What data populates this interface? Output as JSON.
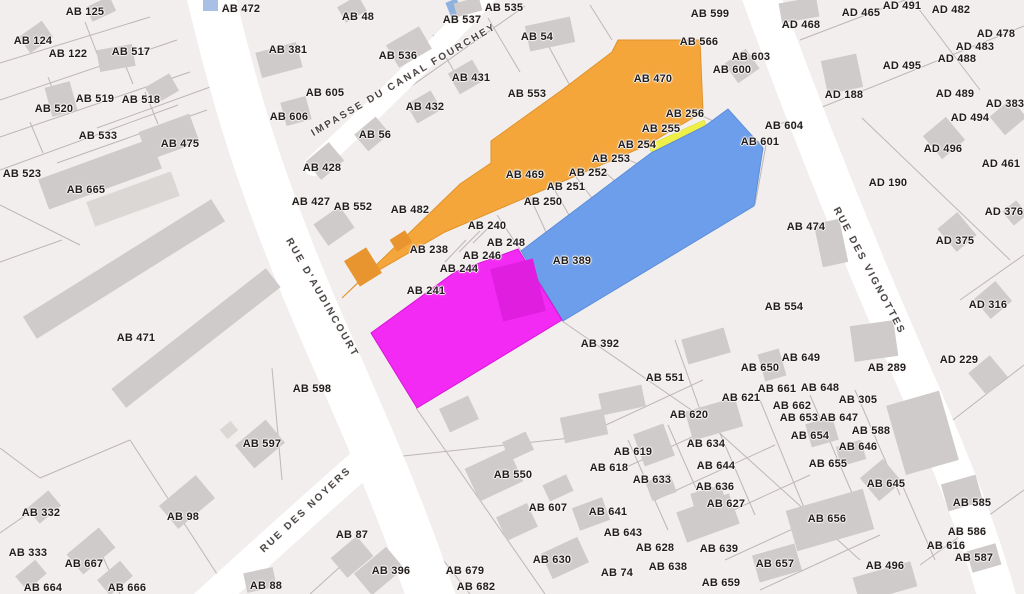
{
  "map": {
    "type": "cadastral-parcel-map",
    "colors": {
      "background": "#f2eeed",
      "road": "#ffffff",
      "building": "#cfcbca",
      "building_light": "#dbd7d5",
      "boundary_line": "#b9b3b2",
      "label_text": "#211d1d",
      "water": "#8fb1e0"
    },
    "highlights": {
      "orange": {
        "color": "#f5a63a",
        "stroke": "#e0932b",
        "parcels": [
          "AB 469",
          "AB 470",
          "AB 255",
          "AB 256"
        ]
      },
      "blue": {
        "color": "#6d9eeb",
        "stroke": "#5d8ed8",
        "parcels": [
          "AB 389"
        ]
      },
      "yellow": {
        "color": "#eff045",
        "stroke": "#d6d63a",
        "parcels": []
      },
      "magenta": {
        "color": "#f32af3",
        "stroke": "#d815d8",
        "parcels": []
      },
      "magenta_building": "#e01ee0",
      "orange_building": "#e8952f"
    },
    "streets": [
      {
        "id": "impasse-du-canal-fourchey",
        "name": "IMPASSE DU CANAL FOURCHEY",
        "x": 404,
        "y": 80,
        "rotation": -30.5
      },
      {
        "id": "rue-d-audincourt",
        "name": "RUE D'AUDINCOURT",
        "x": 322,
        "y": 298,
        "rotation": 60
      },
      {
        "id": "rue-des-noyers",
        "name": "RUE DES NOYERS",
        "x": 306,
        "y": 510,
        "rotation": -43
      },
      {
        "id": "rue-des-vignottes",
        "name": "RUE DES VIGNOTTES",
        "x": 869,
        "y": 271,
        "rotation": 62
      }
    ],
    "parcel_labels": [
      {
        "t": "AB 125",
        "x": 85,
        "y": 12
      },
      {
        "t": "AB 124",
        "x": 33,
        "y": 41
      },
      {
        "t": "AB 122",
        "x": 68,
        "y": 54
      },
      {
        "t": "AB 517",
        "x": 131,
        "y": 52
      },
      {
        "t": "AB 519",
        "x": 95,
        "y": 99
      },
      {
        "t": "AB 518",
        "x": 141,
        "y": 100
      },
      {
        "t": "AB 520",
        "x": 54,
        "y": 109
      },
      {
        "t": "AB 533",
        "x": 98,
        "y": 136
      },
      {
        "t": "AB 475",
        "x": 180,
        "y": 144
      },
      {
        "t": "AB 523",
        "x": 22,
        "y": 174
      },
      {
        "t": "AB 665",
        "x": 86,
        "y": 190
      },
      {
        "t": "AB 472",
        "x": 241,
        "y": 9
      },
      {
        "t": "AB 381",
        "x": 288,
        "y": 50
      },
      {
        "t": "AB 605",
        "x": 325,
        "y": 93
      },
      {
        "t": "AB 606",
        "x": 289,
        "y": 117
      },
      {
        "t": "AB 428",
        "x": 322,
        "y": 168
      },
      {
        "t": "AB 427",
        "x": 311,
        "y": 202
      },
      {
        "t": "AB 552",
        "x": 353,
        "y": 207
      },
      {
        "t": "AB 482",
        "x": 410,
        "y": 210
      },
      {
        "t": "AB 48",
        "x": 358,
        "y": 17
      },
      {
        "t": "AB 537",
        "x": 462,
        "y": 20
      },
      {
        "t": "AB 535",
        "x": 504,
        "y": 8
      },
      {
        "t": "AB 54",
        "x": 537,
        "y": 37
      },
      {
        "t": "AB 536",
        "x": 398,
        "y": 56
      },
      {
        "t": "AB 431",
        "x": 471,
        "y": 78
      },
      {
        "t": "AB 553",
        "x": 527,
        "y": 94
      },
      {
        "t": "AB 432",
        "x": 425,
        "y": 107
      },
      {
        "t": "AB 56",
        "x": 375,
        "y": 135
      },
      {
        "t": "AB 470",
        "x": 653,
        "y": 79
      },
      {
        "t": "AB 256",
        "x": 685,
        "y": 114
      },
      {
        "t": "AB 255",
        "x": 661,
        "y": 129
      },
      {
        "t": "AB 254",
        "x": 637,
        "y": 145
      },
      {
        "t": "AB 253",
        "x": 611,
        "y": 159
      },
      {
        "t": "AB 252",
        "x": 588,
        "y": 173
      },
      {
        "t": "AB 251",
        "x": 566,
        "y": 187
      },
      {
        "t": "AB 250",
        "x": 543,
        "y": 202
      },
      {
        "t": "AB 469",
        "x": 525,
        "y": 175
      },
      {
        "t": "AB 238",
        "x": 429,
        "y": 250
      },
      {
        "t": "AB 240",
        "x": 487,
        "y": 226
      },
      {
        "t": "AB 248",
        "x": 506,
        "y": 243
      },
      {
        "t": "AB 246",
        "x": 482,
        "y": 256
      },
      {
        "t": "AB 244",
        "x": 459,
        "y": 269
      },
      {
        "t": "AB 241",
        "x": 426,
        "y": 291
      },
      {
        "t": "AB 389",
        "x": 572,
        "y": 261
      },
      {
        "t": "AB 392",
        "x": 600,
        "y": 344
      },
      {
        "t": "AB 551",
        "x": 665,
        "y": 378
      },
      {
        "t": "AB 599",
        "x": 710,
        "y": 14
      },
      {
        "t": "AB 566",
        "x": 699,
        "y": 42
      },
      {
        "t": "AB 603",
        "x": 751,
        "y": 57
      },
      {
        "t": "AB 600",
        "x": 732,
        "y": 70
      },
      {
        "t": "AD 468",
        "x": 801,
        "y": 25
      },
      {
        "t": "AD 465",
        "x": 861,
        "y": 13
      },
      {
        "t": "AD 491",
        "x": 902,
        "y": 6
      },
      {
        "t": "AD 482",
        "x": 951,
        "y": 10
      },
      {
        "t": "AD 478",
        "x": 996,
        "y": 34
      },
      {
        "t": "AD 483",
        "x": 975,
        "y": 47
      },
      {
        "t": "AD 488",
        "x": 957,
        "y": 59
      },
      {
        "t": "AD 495",
        "x": 902,
        "y": 66
      },
      {
        "t": "AD 188",
        "x": 844,
        "y": 95
      },
      {
        "t": "AD 489",
        "x": 955,
        "y": 94
      },
      {
        "t": "AD 383",
        "x": 1005,
        "y": 104
      },
      {
        "t": "AD 494",
        "x": 970,
        "y": 118
      },
      {
        "t": "AB 604",
        "x": 784,
        "y": 126
      },
      {
        "t": "AB 601",
        "x": 760,
        "y": 142
      },
      {
        "t": "AD 496",
        "x": 943,
        "y": 149
      },
      {
        "t": "AD 461",
        "x": 1001,
        "y": 164
      },
      {
        "t": "AD 190",
        "x": 888,
        "y": 183
      },
      {
        "t": "AD 376",
        "x": 1004,
        "y": 212
      },
      {
        "t": "AB 474",
        "x": 806,
        "y": 227
      },
      {
        "t": "AD 375",
        "x": 955,
        "y": 241
      },
      {
        "t": "AD 316",
        "x": 988,
        "y": 305
      },
      {
        "t": "AB 554",
        "x": 784,
        "y": 307
      },
      {
        "t": "AD 229",
        "x": 959,
        "y": 360
      },
      {
        "t": "AB 289",
        "x": 887,
        "y": 368
      },
      {
        "t": "AB 471",
        "x": 136,
        "y": 338
      },
      {
        "t": "AB 598",
        "x": 312,
        "y": 389
      },
      {
        "t": "AB 597",
        "x": 262,
        "y": 444
      },
      {
        "t": "AB 332",
        "x": 41,
        "y": 513
      },
      {
        "t": "AB 98",
        "x": 183,
        "y": 517
      },
      {
        "t": "AB 333",
        "x": 28,
        "y": 553
      },
      {
        "t": "AB 667",
        "x": 84,
        "y": 564
      },
      {
        "t": "AB 664",
        "x": 43,
        "y": 588
      },
      {
        "t": "AB 666",
        "x": 127,
        "y": 588
      },
      {
        "t": "AB 88",
        "x": 266,
        "y": 586
      },
      {
        "t": "AB 87",
        "x": 352,
        "y": 535
      },
      {
        "t": "AB 396",
        "x": 391,
        "y": 571
      },
      {
        "t": "AB 679",
        "x": 465,
        "y": 571
      },
      {
        "t": "AB 682",
        "x": 476,
        "y": 587
      },
      {
        "t": "AB 550",
        "x": 513,
        "y": 475
      },
      {
        "t": "AB 618",
        "x": 609,
        "y": 468
      },
      {
        "t": "AB 619",
        "x": 633,
        "y": 452
      },
      {
        "t": "AB 633",
        "x": 652,
        "y": 480
      },
      {
        "t": "AB 607",
        "x": 548,
        "y": 508
      },
      {
        "t": "AB 641",
        "x": 608,
        "y": 512
      },
      {
        "t": "AB 643",
        "x": 623,
        "y": 533
      },
      {
        "t": "AB 628",
        "x": 655,
        "y": 548
      },
      {
        "t": "AB 638",
        "x": 668,
        "y": 567
      },
      {
        "t": "AB 630",
        "x": 552,
        "y": 560
      },
      {
        "t": "AB 74",
        "x": 617,
        "y": 573
      },
      {
        "t": "AB 620",
        "x": 689,
        "y": 415
      },
      {
        "t": "AB 621",
        "x": 741,
        "y": 398
      },
      {
        "t": "AB 650",
        "x": 760,
        "y": 368
      },
      {
        "t": "AB 649",
        "x": 801,
        "y": 358
      },
      {
        "t": "AB 661",
        "x": 777,
        "y": 389
      },
      {
        "t": "AB 648",
        "x": 820,
        "y": 388
      },
      {
        "t": "AB 305",
        "x": 858,
        "y": 400
      },
      {
        "t": "AB 662",
        "x": 792,
        "y": 406
      },
      {
        "t": "AB 653",
        "x": 799,
        "y": 418
      },
      {
        "t": "AB 647",
        "x": 839,
        "y": 418
      },
      {
        "t": "AB 654",
        "x": 810,
        "y": 436
      },
      {
        "t": "AB 588",
        "x": 871,
        "y": 431
      },
      {
        "t": "AB 646",
        "x": 858,
        "y": 447
      },
      {
        "t": "AB 634",
        "x": 706,
        "y": 444
      },
      {
        "t": "AB 655",
        "x": 828,
        "y": 464
      },
      {
        "t": "AB 644",
        "x": 716,
        "y": 466
      },
      {
        "t": "AB 645",
        "x": 886,
        "y": 484
      },
      {
        "t": "AB 636",
        "x": 715,
        "y": 487
      },
      {
        "t": "AB 627",
        "x": 726,
        "y": 504
      },
      {
        "t": "AB 585",
        "x": 972,
        "y": 503
      },
      {
        "t": "AB 656",
        "x": 827,
        "y": 519
      },
      {
        "t": "AB 586",
        "x": 967,
        "y": 532
      },
      {
        "t": "AB 639",
        "x": 719,
        "y": 549
      },
      {
        "t": "AB 616",
        "x": 946,
        "y": 546
      },
      {
        "t": "AB 587",
        "x": 974,
        "y": 558
      },
      {
        "t": "AB 657",
        "x": 775,
        "y": 564
      },
      {
        "t": "AB 496",
        "x": 885,
        "y": 566
      },
      {
        "t": "AB 659",
        "x": 721,
        "y": 583
      }
    ]
  }
}
